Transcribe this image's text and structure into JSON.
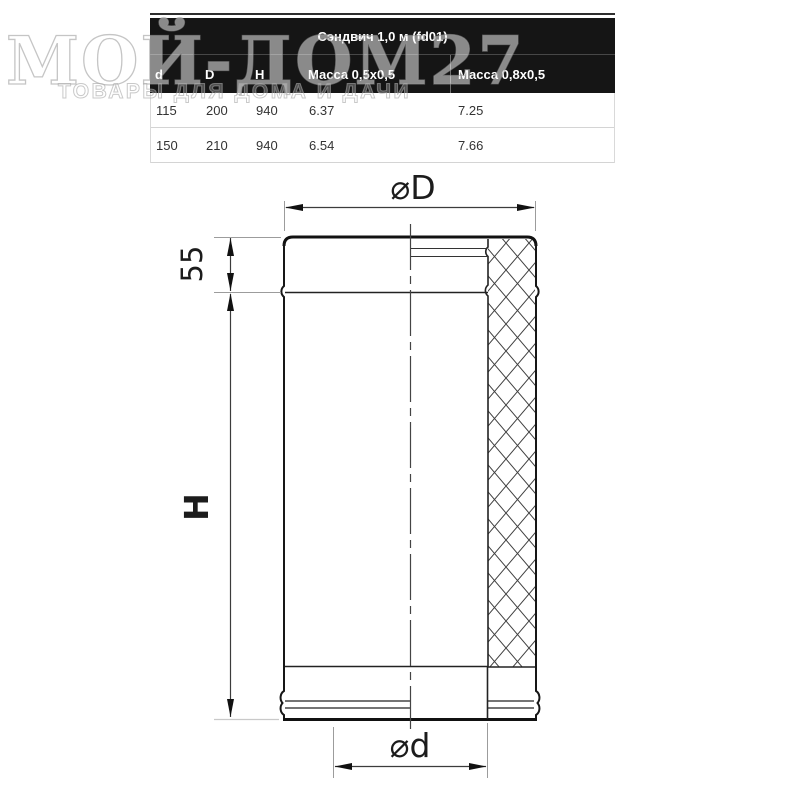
{
  "watermark": {
    "title": "МОЙ-ДОМ27",
    "subtitle": "ТОВАРЫ ДЛЯ ДОМА И ДАЧИ"
  },
  "table": {
    "title": "Сэндвич 1,0 м (fd01)",
    "columns": [
      "d",
      "D",
      "H",
      "Масса 0,5x0,5",
      "Масса 0,8x0,5"
    ],
    "rows": [
      [
        "115",
        "200",
        "940",
        "6.37",
        "7.25"
      ],
      [
        "150",
        "210",
        "940",
        "6.54",
        "7.66"
      ]
    ]
  },
  "diagram": {
    "labels": {
      "outer_diameter": "⌀D",
      "inner_diameter": "⌀d",
      "height": "H",
      "socket_depth": "55"
    }
  },
  "colors": {
    "header_bg": "#151515",
    "header_text": "#ffffff",
    "row_border": "#d4d4d4",
    "line": "#1a1a1a",
    "extension_line": "#9c9c9c"
  }
}
